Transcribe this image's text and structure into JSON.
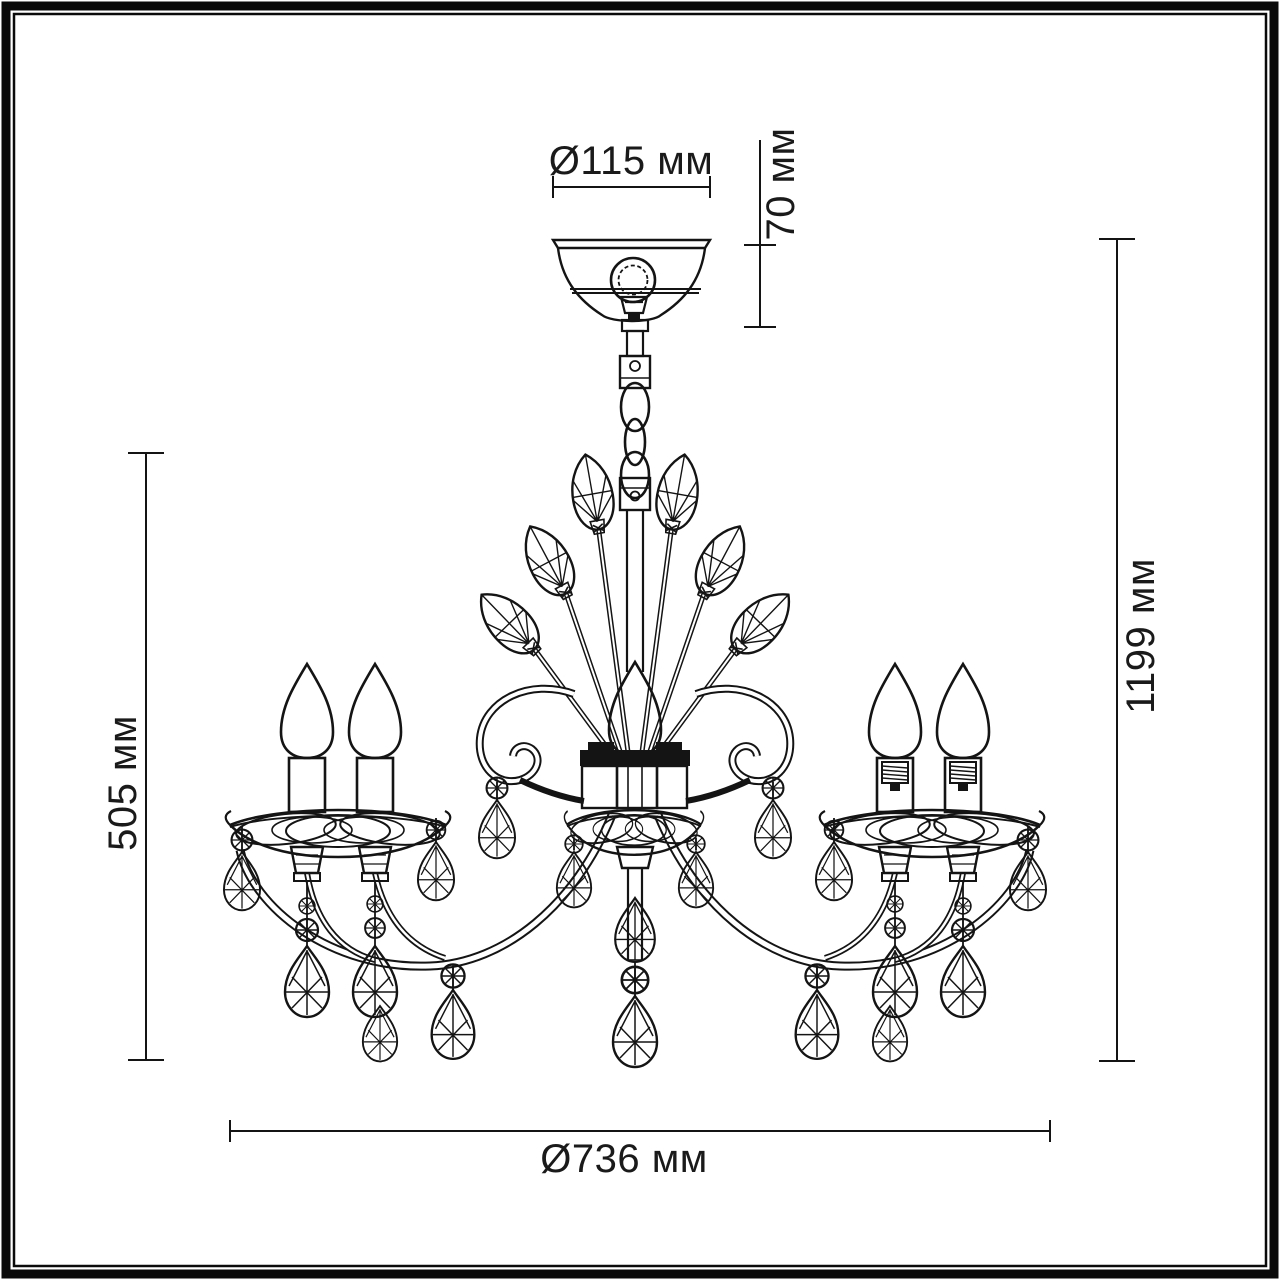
{
  "page": {
    "background": "#ffffff",
    "line_color": "#141414",
    "frame": "double black border"
  },
  "drawing": {
    "type": "technical dimension diagram",
    "subject": "crystal chandelier with candle bulbs, leaf crystals and teardrop pendants, front view",
    "units": "мм"
  },
  "dimensions": {
    "canopy_diameter": {
      "label": "Ø115 мм",
      "orientation": "horizontal-top"
    },
    "canopy_height": {
      "label": "70 мм",
      "orientation": "vertical-top-right"
    },
    "body_height": {
      "label": "505 мм",
      "orientation": "vertical-left"
    },
    "overall_height": {
      "label": "1199 мм",
      "orientation": "vertical-right"
    },
    "overall_diameter": {
      "label": "Ø736 мм",
      "orientation": "horizontal-bottom"
    }
  }
}
